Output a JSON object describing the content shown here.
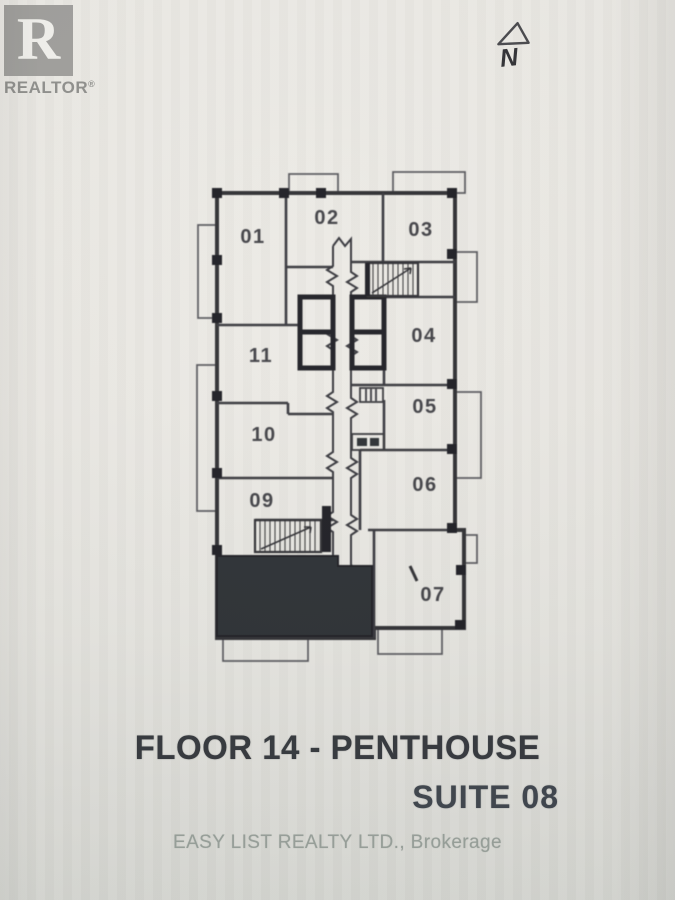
{
  "branding": {
    "logo_letter": "R",
    "logo_label": "REALTOR",
    "registered": "®"
  },
  "compass": {
    "label": "N"
  },
  "floor_plan": {
    "units": [
      {
        "id": "01"
      },
      {
        "id": "02"
      },
      {
        "id": "03"
      },
      {
        "id": "04"
      },
      {
        "id": "05"
      },
      {
        "id": "06"
      },
      {
        "id": "07"
      },
      {
        "id": "09"
      },
      {
        "id": "10"
      },
      {
        "id": "11"
      }
    ],
    "highlighted_suite": "08",
    "features": [
      "stairwell-top",
      "stairwell-bottom",
      "elevator-core",
      "corridor",
      "balconies"
    ]
  },
  "caption": {
    "floor_line": "FLOOR 14 - PENTHOUSE",
    "suite_line": "SUITE 08"
  },
  "watermark": "EASY LIST REALTY LTD., Brokerage",
  "colors": {
    "paper": "#e9e7e2",
    "ink": "#35353a",
    "core_ink": "#1d1d20",
    "highlight_fill": "#2a2e30",
    "logo_gray": "#a09f9c",
    "watermark_gray": "#98a09a"
  }
}
